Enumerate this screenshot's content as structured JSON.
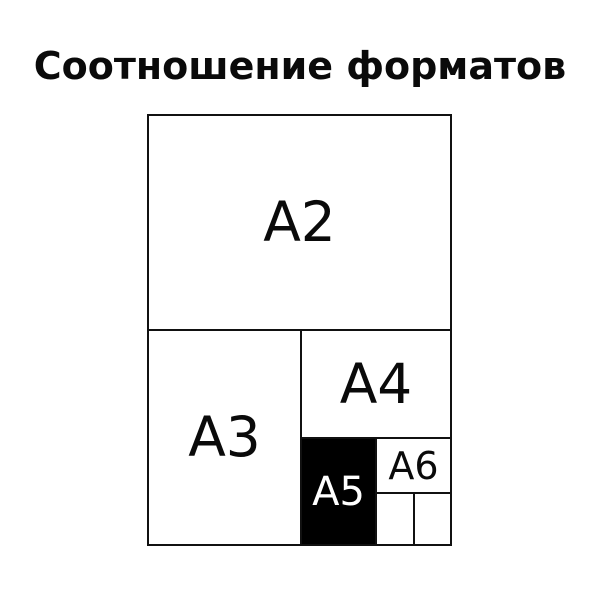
{
  "title": "Соотношение форматов",
  "diagram": {
    "description": "Nested comparison of paper format sizes",
    "formats": {
      "a2": {
        "label": "A2"
      },
      "a3": {
        "label": "A3"
      },
      "a4": {
        "label": "A4"
      },
      "a5": {
        "label": "A5",
        "fill": "#000000",
        "text_color": "#ffffff",
        "highlighted": true
      },
      "a6": {
        "label": "A6"
      }
    },
    "colors": {
      "background": "#ffffff",
      "line": "#111111",
      "label_text": "#0a0a0a",
      "a5_fill": "#000000",
      "a5_text": "#ffffff"
    }
  }
}
